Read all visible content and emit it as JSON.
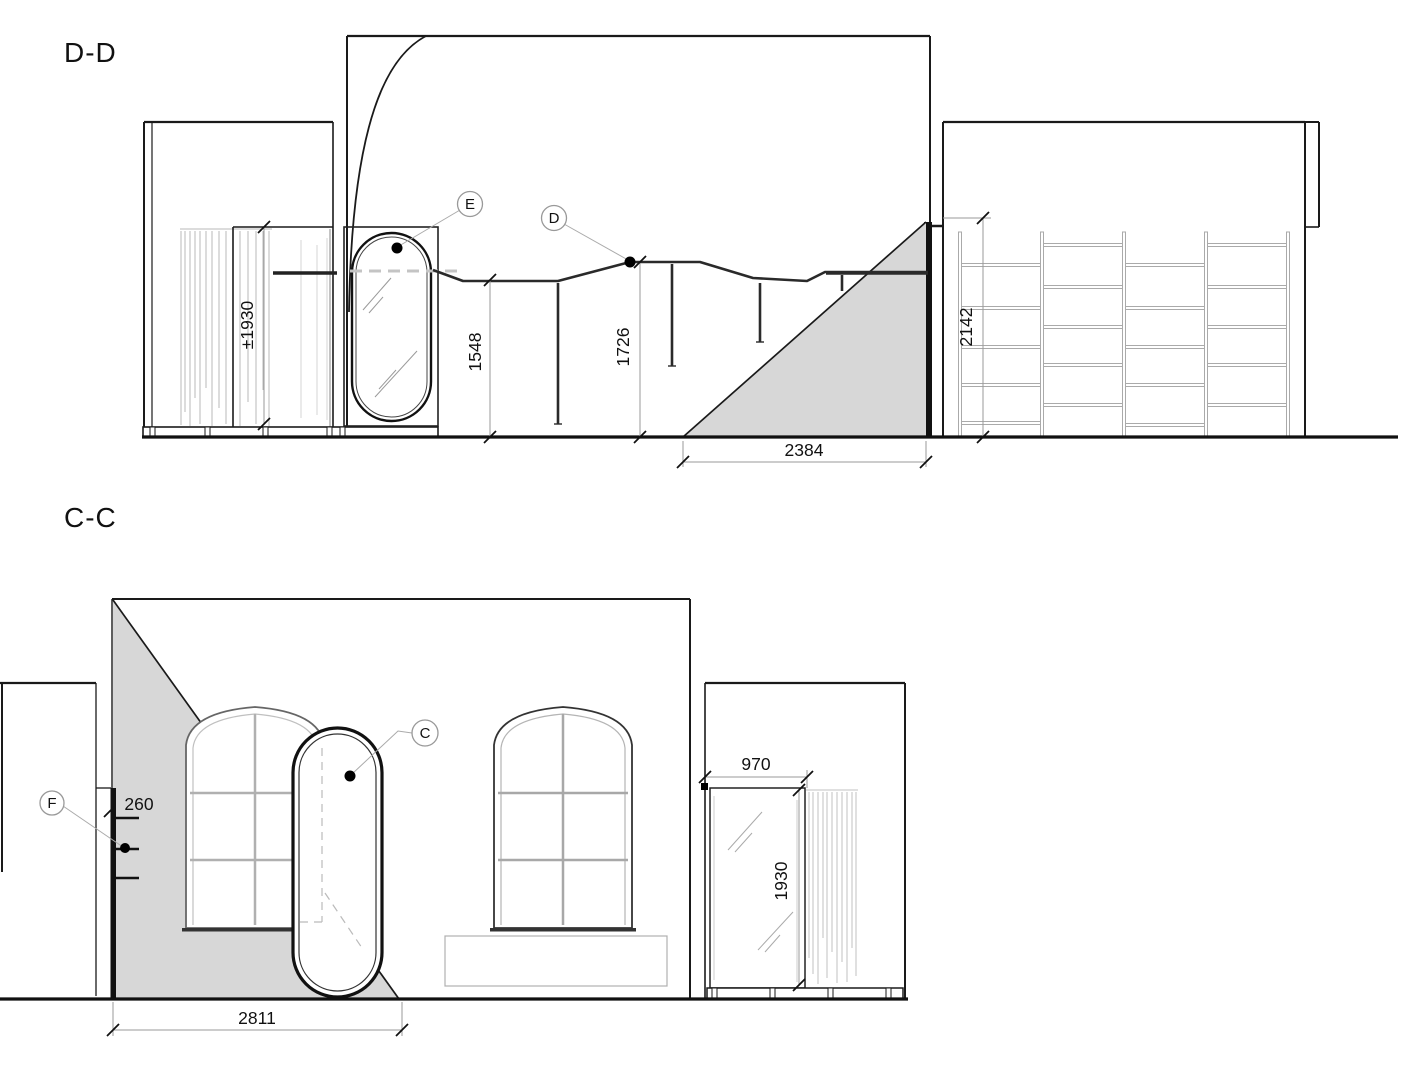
{
  "drawing": {
    "section_dd": {
      "title": "D-D",
      "callout_e": "E",
      "callout_d": "D",
      "dim_shower_glass_height": "±1930",
      "dim_rail_left_height": "1548",
      "dim_rail_mid_height": "1726",
      "dim_shelving_height": "2142",
      "dim_wall_span": "2384"
    },
    "section_cc": {
      "title": "C-C",
      "callout_c": "C",
      "callout_f": "F",
      "dim_shelf_depth": "260",
      "dim_wall_span": "2811",
      "dim_glass_width": "970",
      "dim_glass_height": "1930"
    },
    "colors": {
      "line_dark": "#1a1a1a",
      "line_light": "#b5b5b5",
      "wall_fill": "#111111",
      "section_gray": "#d7d7d7",
      "dimension_gray": "#999999"
    }
  }
}
